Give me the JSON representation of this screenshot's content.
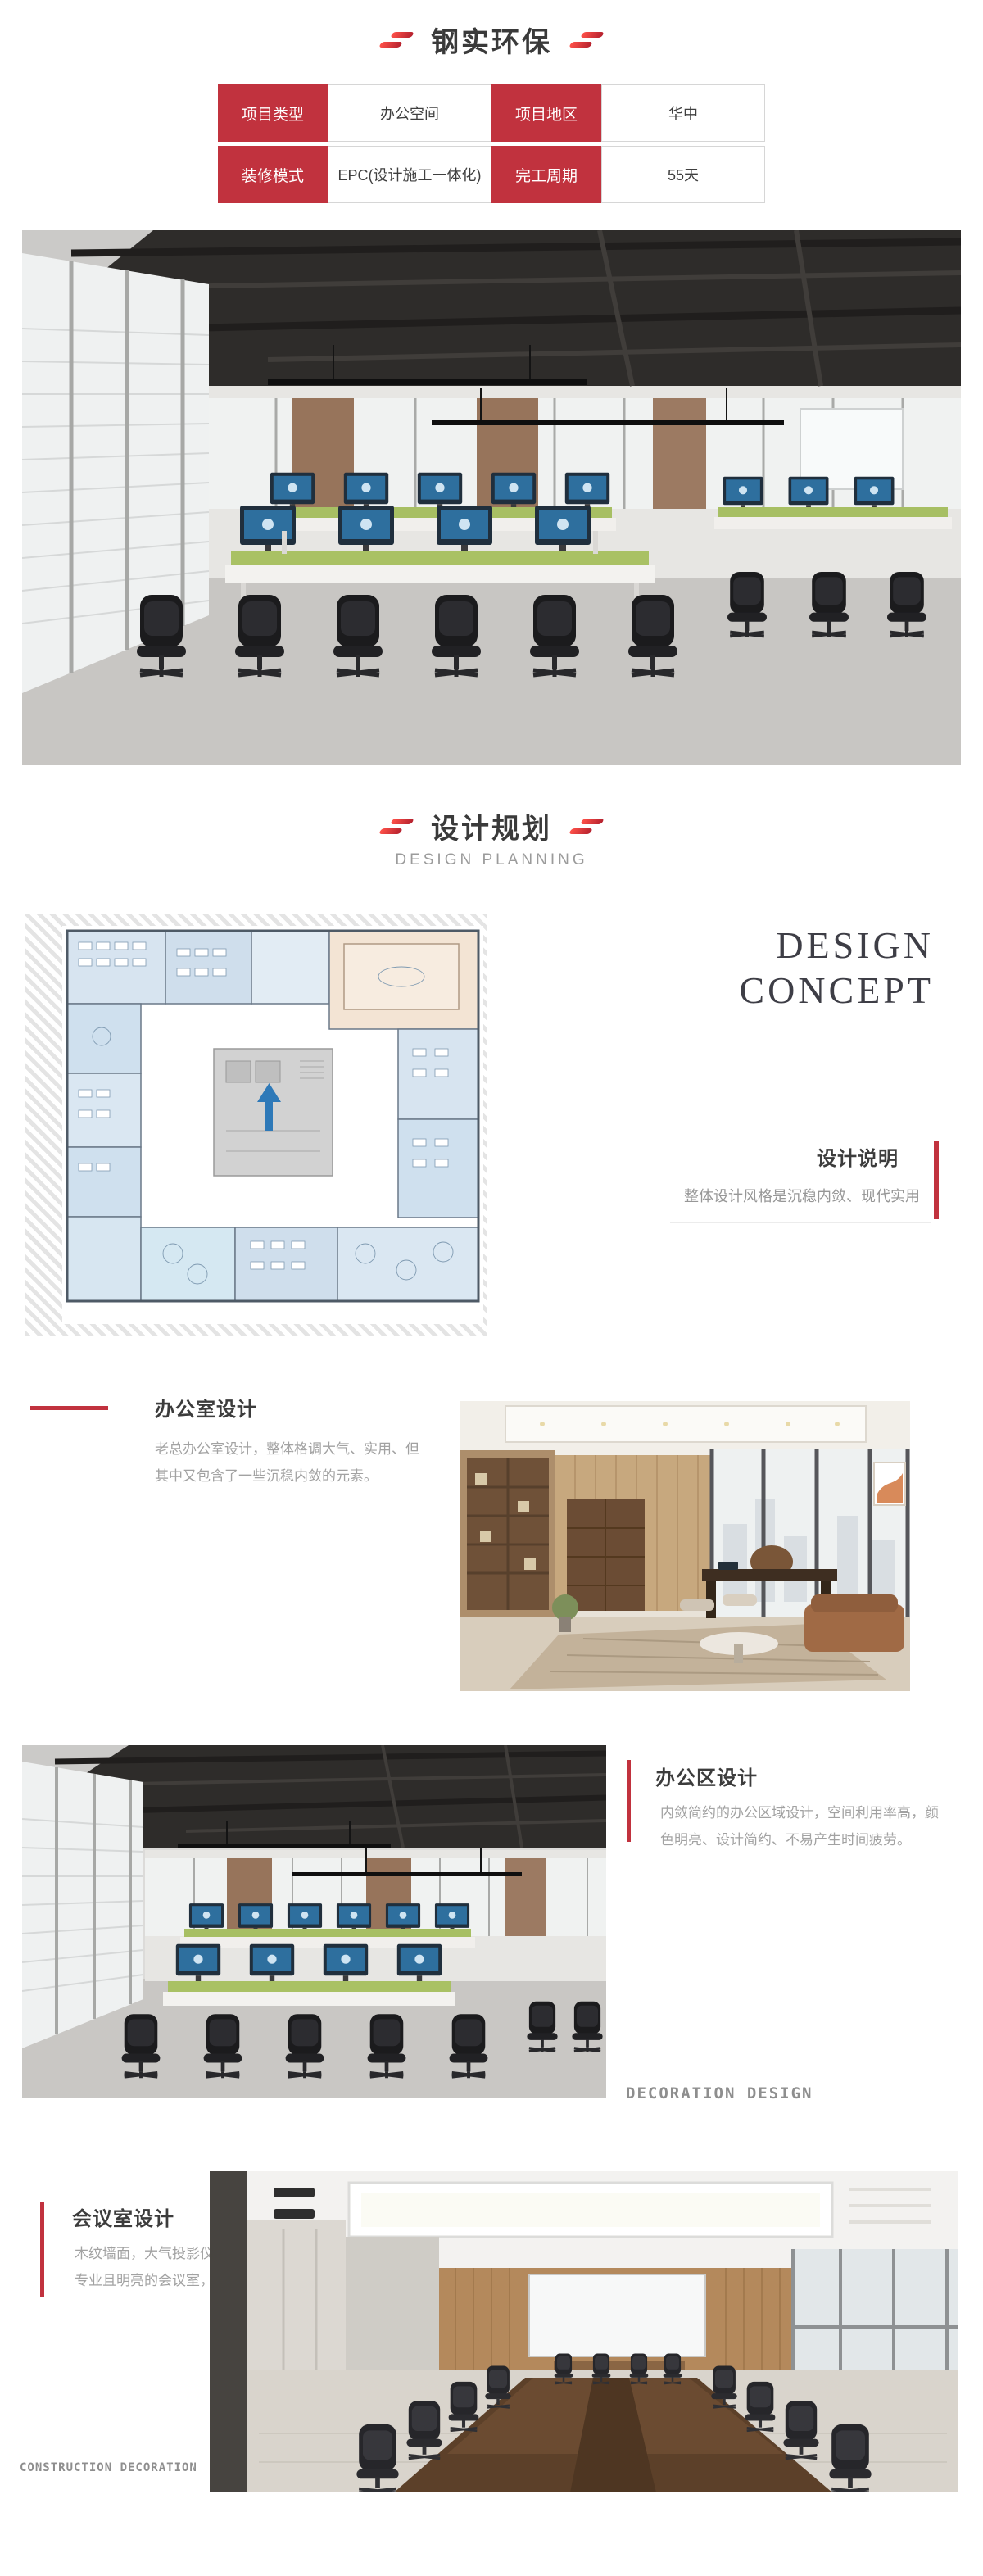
{
  "theme": {
    "accent_red": "#c1323e",
    "title_color": "#3c3c3c",
    "body_text_color": "#a2a2a2"
  },
  "header": {
    "title": "钢实环保"
  },
  "info_table": {
    "rows": [
      {
        "label1": "项目类型",
        "value1": "办公空间",
        "label2": "项目地区",
        "value2": "华中"
      },
      {
        "label1": "装修模式",
        "value1": "EPC(设计施工一体化)",
        "label2": "完工周期",
        "value2": "55天"
      }
    ]
  },
  "planning_section": {
    "title": "设计规划",
    "subtitle": "DESIGN PLANNING"
  },
  "concept": {
    "word1": "DESIGN",
    "word2": "CONCEPT",
    "heading": "设计说明",
    "description": "整体设计风格是沉稳内敛、现代实用"
  },
  "office_design": {
    "title": "办公室设计",
    "line1": "老总办公室设计，整体格调大气、实用、但",
    "line2": "其中又包含了一些沉稳内敛的元素。"
  },
  "workspace_design": {
    "title": "办公区设计",
    "line1": "内敛简约的办公区域设计，空间利用率高，颜",
    "line2": "色明亮、设计简约、不易产生时间疲劳。",
    "watermark": "DECORATION DESIGN"
  },
  "meeting_design": {
    "title": "会议室设计",
    "line1": "木纹墙面，大气投影仪，高亮白光吊顶，营造出",
    "line2": "专业且明亮的会议室，氛围感瞬间拉满",
    "watermark": "CONSTRUCTION DECORATION"
  }
}
